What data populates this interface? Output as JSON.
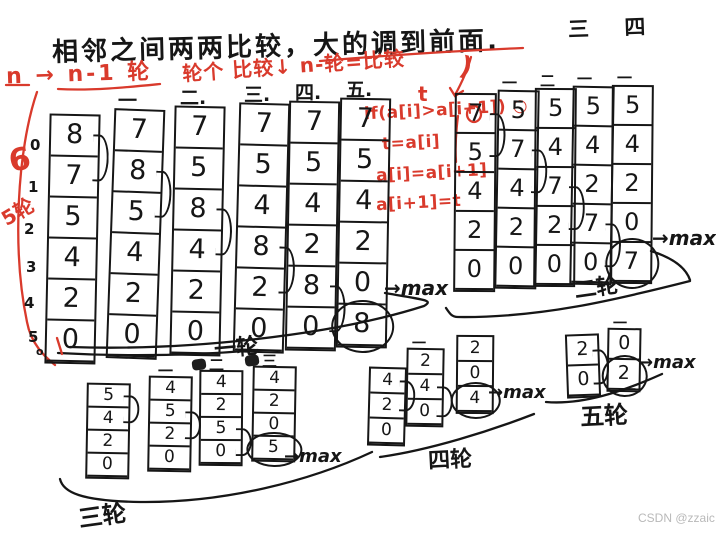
{
  "title": "相邻之间两两比较，大的调到前面.",
  "top_right_label": "三  四",
  "watermark": "CSDN @zzaic",
  "red_notes": {
    "rounds_formula": "n → n-1 轮",
    "per_round_formula": "轮个 比较↓ n-轮=比较",
    "paren": ")",
    "six": "6",
    "five_rounds": "5轮",
    "t_var": "t",
    "code": [
      "if(a[i]>a[i+1]) ○",
      "t=a[i]",
      "a[i]=a[i+1]",
      "a[i+1]=t"
    ]
  },
  "indices": [
    "0",
    "1",
    "2",
    "3",
    "4",
    "5",
    "o"
  ],
  "passes": [
    {
      "label": "一轮",
      "max_note": "→max",
      "columns": [
        {
          "header": "",
          "values": [
            8,
            7,
            5,
            4,
            2,
            0
          ],
          "arc_after": 0
        },
        {
          "header": "一",
          "values": [
            7,
            8,
            5,
            4,
            2,
            0
          ],
          "arc_after": 1
        },
        {
          "header": "二.",
          "values": [
            7,
            5,
            8,
            4,
            2,
            0
          ],
          "arc_after": 2
        },
        {
          "header": "三.",
          "values": [
            7,
            5,
            4,
            8,
            2,
            0
          ],
          "arc_after": 3
        },
        {
          "header": "四.",
          "values": [
            7,
            5,
            4,
            2,
            8,
            0
          ],
          "arc_after": 4
        },
        {
          "header": "五.",
          "values": [
            7,
            5,
            4,
            2,
            0,
            8
          ],
          "circled": 5
        }
      ]
    },
    {
      "label": "二轮",
      "max_note": "→max",
      "columns": [
        {
          "header": "",
          "values": [
            7,
            5,
            4,
            2,
            0
          ],
          "arc_after": 0
        },
        {
          "header": "一",
          "values": [
            5,
            7,
            4,
            2,
            0
          ],
          "arc_after": 1
        },
        {
          "header": "二",
          "values": [
            5,
            4,
            7,
            2,
            0
          ],
          "arc_after": 2
        },
        {
          "header": "一",
          "values": [
            5,
            4,
            2,
            7,
            0
          ],
          "arc_after": 3
        },
        {
          "header": "一",
          "values": [
            5,
            4,
            2,
            0,
            7
          ],
          "circled": 4
        }
      ]
    },
    {
      "label": "三轮",
      "max_note": "→max",
      "columns": [
        {
          "header": "",
          "values": [
            5,
            4,
            2,
            0
          ],
          "arc_after": 0
        },
        {
          "header": "一",
          "values": [
            4,
            5,
            2,
            0
          ],
          "arc_after": 1
        },
        {
          "header": "二",
          "values": [
            4,
            2,
            5,
            0
          ],
          "arc_after": 2,
          "scribble": true
        },
        {
          "header": "三",
          "values": [
            4,
            2,
            0,
            5
          ],
          "circled": 3,
          "scribble": true
        }
      ]
    },
    {
      "label": "四轮",
      "max_note": "→max",
      "columns": [
        {
          "header": "",
          "values": [
            4,
            2,
            0
          ],
          "arc_after": 0
        },
        {
          "header": "一",
          "values": [
            2,
            4,
            0
          ],
          "arc_after": 1
        },
        {
          "header": "",
          "values": [
            2,
            0,
            4
          ],
          "circled": 2
        }
      ]
    },
    {
      "label": "五轮",
      "max_note": "→max",
      "columns": [
        {
          "header": "",
          "values": [
            2,
            0
          ],
          "arc_after": 0
        },
        {
          "header": "一",
          "values": [
            0,
            2
          ],
          "circled": 1
        }
      ]
    }
  ]
}
